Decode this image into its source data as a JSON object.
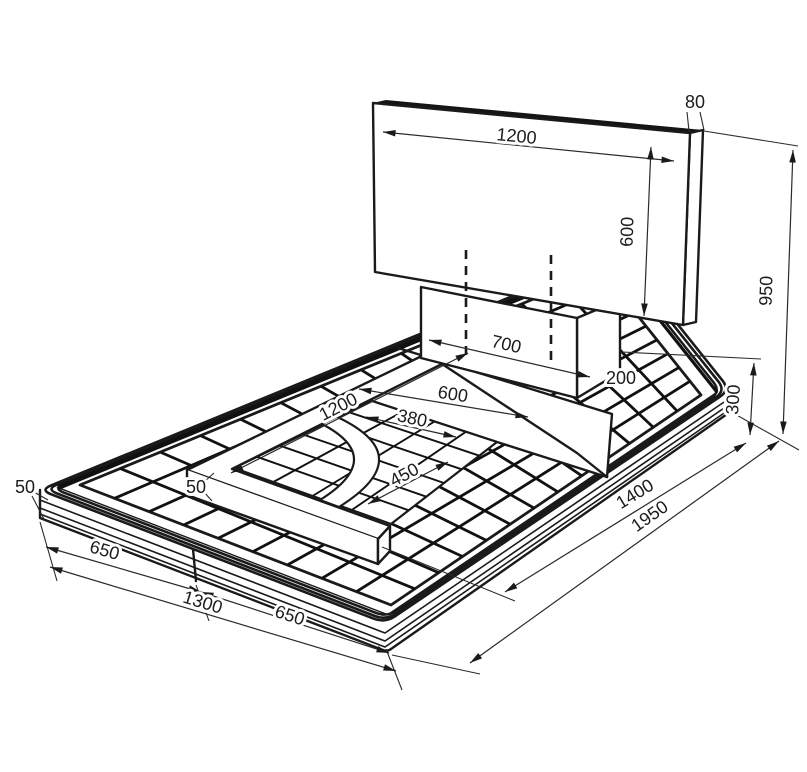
{
  "drawing": {
    "kind": "isometric dimensioned technical drawing",
    "subject": "tiled shower platform with recessed tray, curb, pedestal and back panel",
    "unit": "mm",
    "line_color": "#1a1a1a",
    "background": "#ffffff"
  },
  "labels": {
    "panel_width": "1200",
    "panel_thickness": "80",
    "panel_height": "600",
    "overall_height": "950",
    "pedestal_width": "700",
    "pedestal_depth": "200",
    "pedestal_height": "300",
    "shelf_width": "600",
    "recess_length": "1200",
    "recess_upper_width": "380",
    "recess_inner_width": "450",
    "curb_width": "50",
    "slab_thickness": "50",
    "front_segment_a": "650",
    "front_total": "1300",
    "front_segment_b": "650",
    "side_partial": "1400",
    "side_total": "1950"
  }
}
